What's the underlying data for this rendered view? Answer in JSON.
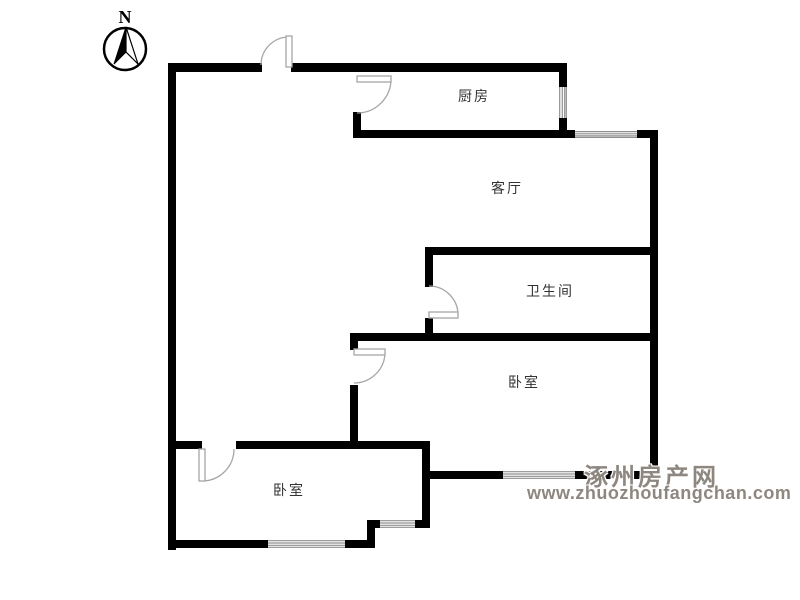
{
  "compass": {
    "north_label": "N"
  },
  "rooms": {
    "kitchen": {
      "label": "厨房"
    },
    "living_room": {
      "label": "客厅"
    },
    "bathroom": {
      "label": "卫生间"
    },
    "bedroom_right": {
      "label": "卧室"
    },
    "bedroom_left": {
      "label": "卧室"
    }
  },
  "watermark": {
    "site_name": "涿州房产网",
    "site_url": "www.zhuozhoufangchan.com"
  },
  "colors": {
    "wall": "#000000",
    "door_line": "#a6a6a6",
    "window_line": "#8f8f8f",
    "room_label": "#333333",
    "watermark_text": "#8d8780",
    "background": "#ffffff"
  }
}
